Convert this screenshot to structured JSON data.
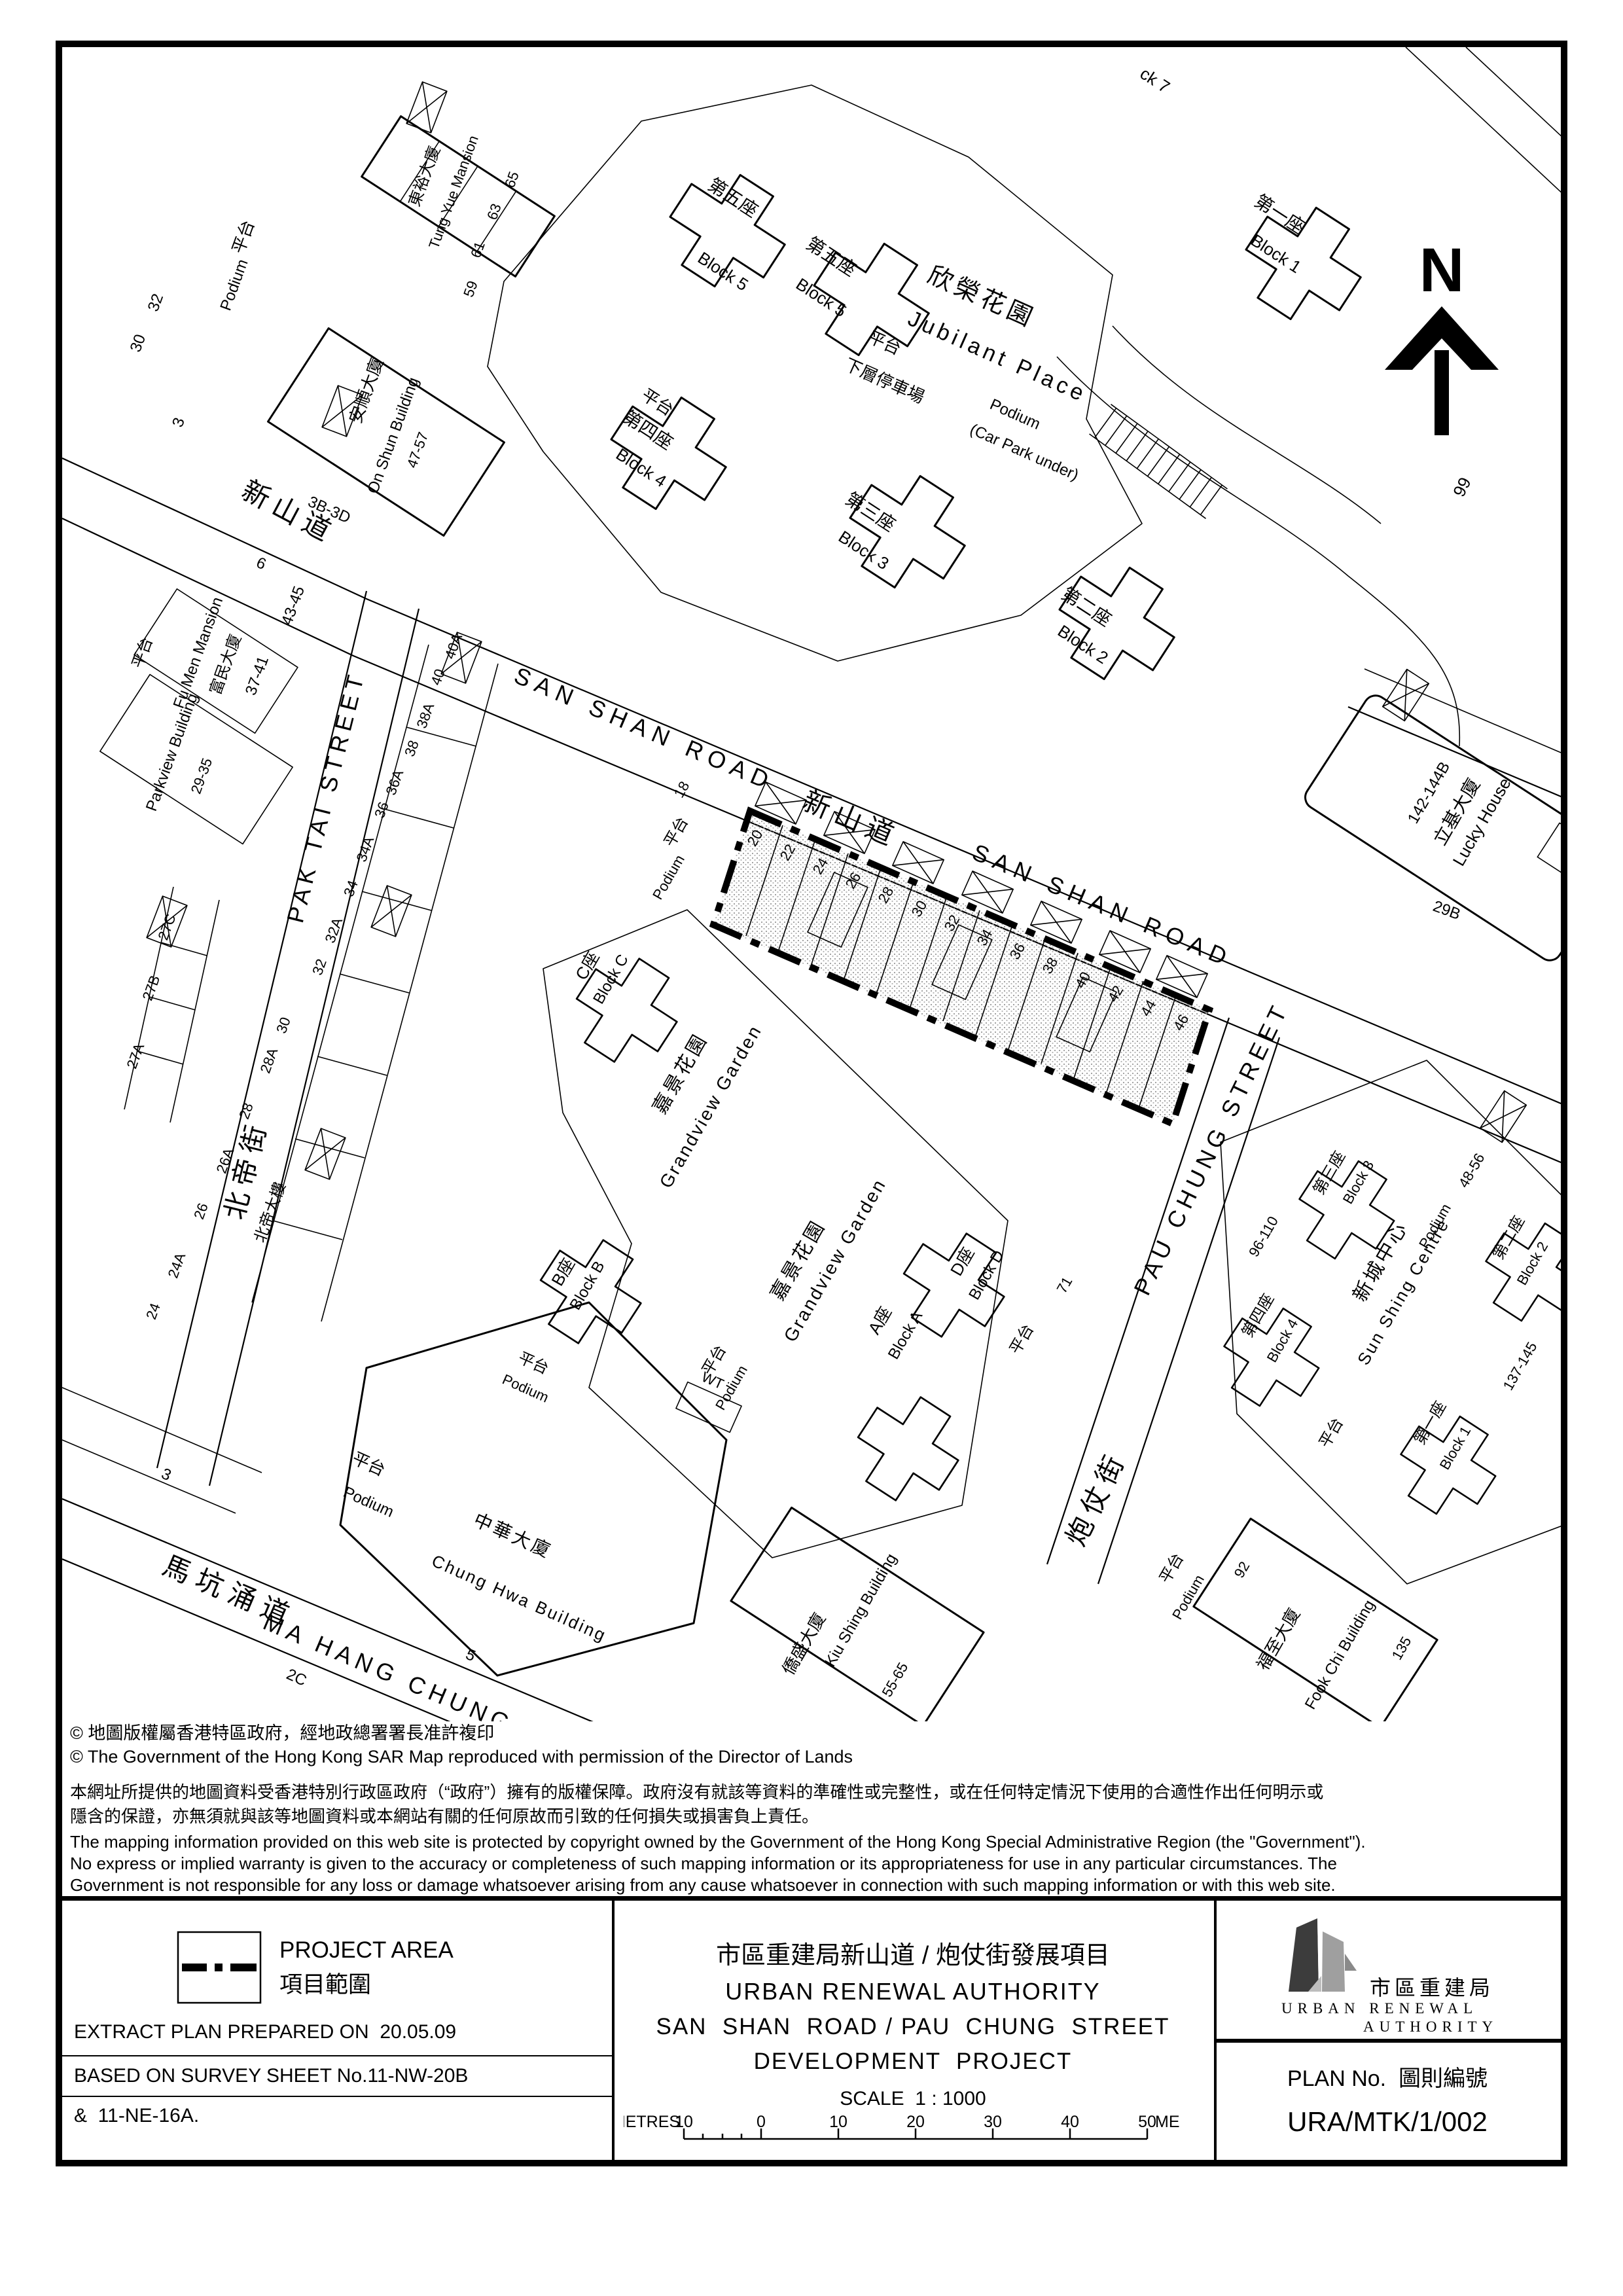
{
  "map": {
    "north_label": "N",
    "labels": {
      "san_shan_en": "SAN SHAN ROAD",
      "san_shan_zh": "新山道",
      "pak_tai_en": "PAK TAI STREET",
      "pak_tai_zh": "北帝街",
      "pau_chung_en": "PAU CHUNG STREET",
      "pau_chung_zh": "炮仗街",
      "ma_hang_en": "MA HANG CHUNG ROAD",
      "ma_hang_zh": "馬坑涌道",
      "jubilant_en": "Jubilant Place",
      "jubilant_zh": "欣榮花園",
      "grandview_en": "Grandview Garden",
      "grandview_zh": "嘉景花園",
      "sun_shing_en": "Sun Shing Centre",
      "sun_shing_zh": "新城中心",
      "lucky_en": "Lucky House",
      "lucky_zh": "立基大廈",
      "chung_hwa_en": "Chung Hwa Building",
      "chung_hwa_zh": "中華大廈",
      "kiu_shing_en": "Kiu Shing Building",
      "kiu_shing_zh": "僑盛大廈",
      "fook_chi_en": "Fook Chi Building",
      "fook_chi_zh": "福至大廈",
      "on_shun_en": "On Shun Building",
      "on_shun_zh": "安順大廈",
      "fu_men_en": "Fu Men Mansion",
      "fu_men_zh": "富民大廈",
      "parkview_en": "Parkview Building",
      "tung_yue_en": "Tung Yue Mansion",
      "tung_yue_zh": "東裕大廈",
      "pak_tai_bldg_zh": "北帝大樓",
      "podium_zh": "平台",
      "podium_en": "Podium",
      "carpark_zh": "下層停車場",
      "carpark_en": "(Car Park under)",
      "block1_zh": "第一座",
      "block1_en": "Block 1",
      "block2_zh": "第二座",
      "block2_en": "Block 2",
      "block3_zh": "第三座",
      "block3_en": "Block 3",
      "block4_zh": "第四座",
      "block4_en": "Block 4",
      "block5_zh": "第五座",
      "block5_en": "Block 5",
      "block7_part": "ck 7",
      "blockA_zh": "A座",
      "blockA_en": "Block A",
      "blockB_zh": "B座",
      "blockB_en": "Block B",
      "blockC_zh": "C座",
      "blockC_en": "Block C",
      "blockD_zh": "D座",
      "blockD_en": "Block D",
      "wt": "WT"
    },
    "numbers": {
      "n3": "3",
      "n5": "5",
      "n6": "6",
      "n18": "18",
      "n71": "71",
      "n92": "92",
      "n99": "99",
      "n135": "135",
      "n2c": "2C",
      "n29b": "29B",
      "n32": "32",
      "n30": "30",
      "n59": "59",
      "n61": "61",
      "n63": "63",
      "n65": "65",
      "n29_35": "29-35",
      "n37_41": "37-41",
      "n43_45": "43-45",
      "n47_57": "47-57",
      "n3b_3d": "3B-3D",
      "n48_56": "48-56",
      "n55_65": "55-65",
      "n96_110": "96-110",
      "n137_145": "137-145",
      "n142_144b": "142-144B"
    },
    "lot_numbers": [
      "20",
      "22",
      "24",
      "26",
      "28",
      "30",
      "32",
      "34",
      "36",
      "38",
      "40",
      "42",
      "44",
      "46"
    ],
    "pak_tai_strip": [
      "24",
      "24A",
      "26",
      "26A",
      "28",
      "28A",
      "30",
      "32",
      "32A",
      "34",
      "34A",
      "36",
      "36A",
      "38",
      "38A",
      "40",
      "40A"
    ],
    "west_strip": [
      "27A",
      "27B",
      "27C"
    ]
  },
  "notices": {
    "copyright_zh": "© 地圖版權屬香港特區政府，經地政總署署長准許複印",
    "copyright_en": "© The Government of the Hong Kong SAR Map reproduced with permission of the Director of Lands",
    "disclaimer_zh_1": "本網址所提供的地圖資料受香港特別行政區政府（“政府”）擁有的版權保障。政府沒有就該等資料的準確性或完整性，或在任何特定情況下使用的合適性作出任何明示或",
    "disclaimer_zh_2": "隱含的保證，亦無須就與該等地圖資料或本網站有關的任何原故而引致的任何損失或損害負上責任。",
    "disclaimer_en_1": "The mapping information provided on this web site is protected by copyright owned by the Government of the Hong Kong Special Administrative Region (the \"Government\").",
    "disclaimer_en_2": "No express or implied warranty is given to the accuracy or completeness of such mapping information or its appropriateness for use in any particular circumstances. The",
    "disclaimer_en_3": "Government is not responsible for any loss or damage whatsoever arising from any cause whatsoever in connection with such mapping information or with this web site."
  },
  "title_block": {
    "legend_en": "PROJECT AREA",
    "legend_zh": "項目範圍",
    "note_1": "EXTRACT PLAN PREPARED ON  20.05.09",
    "note_2": "BASED ON SURVEY SHEET No.11-NW-20B",
    "note_3": "&  11-NE-16A.",
    "project_title_zh": "市區重建局新山道 / 炮仗街發展項目",
    "authority_en": "URBAN RENEWAL AUTHORITY",
    "project_title_en_1": "SAN  SHAN  ROAD / PAU  CHUNG  STREET",
    "project_title_en_2": "DEVELOPMENT  PROJECT",
    "scale_label": "SCALE  1 : 1000",
    "scale_unit": "METRES",
    "scale_ticks": [
      "10",
      "0",
      "10",
      "20",
      "30",
      "40",
      "50"
    ],
    "logo_zh": "市區重建局",
    "logo_en_1": "URBAN RENEWAL",
    "logo_en_2": "AUTHORITY",
    "plan_no_label": "PLAN No.  圖則編號",
    "plan_no": "URA/MTK/1/002"
  }
}
